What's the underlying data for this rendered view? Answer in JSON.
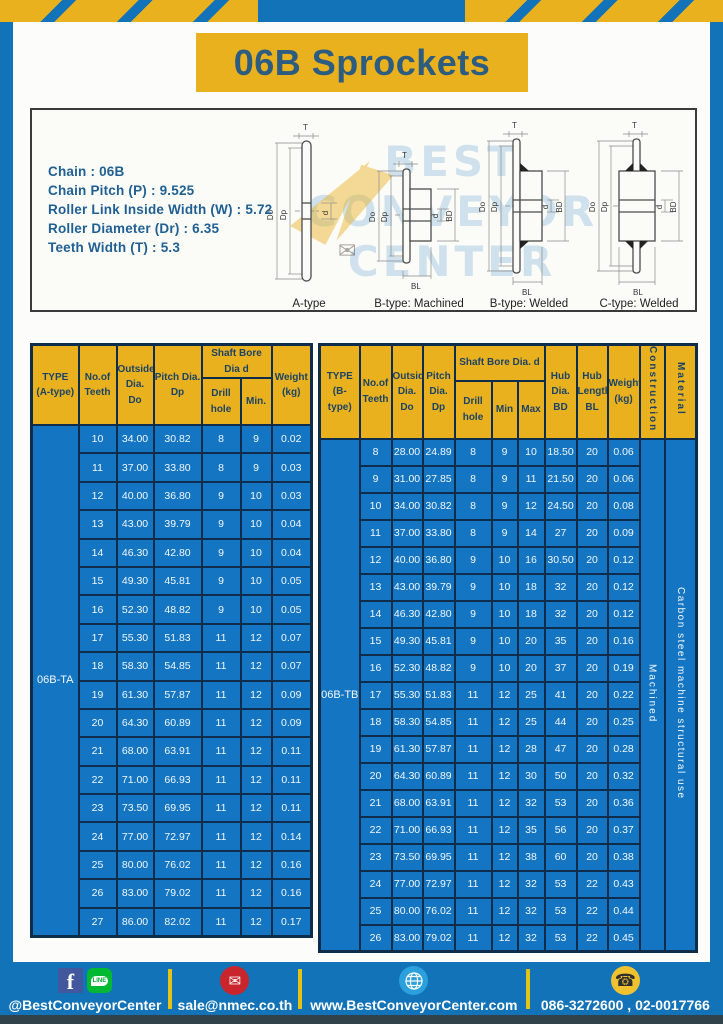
{
  "title": "06B Sprockets",
  "specs": [
    "Chain  : 06B",
    "Chain Pitch (P)  :  9.525",
    "Roller Link Inside Width (W)  :  5.72",
    "Roller Diameter (Dr)  : 6.35",
    "Teeth Width (T)  :  5.3"
  ],
  "diagram": {
    "types": [
      "A-type",
      "B-type: Machined",
      "B-type: Welded",
      "C-type: Welded"
    ],
    "dims": {
      "t": "T",
      "outside": "Do",
      "pitch": "Dp",
      "bore": "d",
      "hub_dia": "BD",
      "hub_len": "BL"
    },
    "watermark": [
      "BEST",
      "CONVEYOR",
      "CENTER"
    ],
    "watermark_envelope_icon": "✉"
  },
  "table_a": {
    "headers": {
      "type": [
        "TYPE",
        "(A-type)"
      ],
      "teeth": [
        "No.of",
        "Teeth"
      ],
      "outside": [
        "Outside",
        "Dia.",
        "Do"
      ],
      "pitch": [
        "Pitch Dia.",
        "Dp"
      ],
      "shaft_group": "Shaft Bore Dia d",
      "drill": "Drill hole",
      "min": "Min.",
      "weight": [
        "Weight",
        "(kg)"
      ]
    },
    "type_value": "06B-TA",
    "rows": [
      [
        "10",
        "34.00",
        "30.82",
        "8",
        "9",
        "0.02"
      ],
      [
        "11",
        "37.00",
        "33.80",
        "8",
        "9",
        "0.03"
      ],
      [
        "12",
        "40.00",
        "36.80",
        "9",
        "10",
        "0.03"
      ],
      [
        "13",
        "43.00",
        "39.79",
        "9",
        "10",
        "0.04"
      ],
      [
        "14",
        "46.30",
        "42.80",
        "9",
        "10",
        "0.04"
      ],
      [
        "15",
        "49.30",
        "45.81",
        "9",
        "10",
        "0.05"
      ],
      [
        "16",
        "52.30",
        "48.82",
        "9",
        "10",
        "0.05"
      ],
      [
        "17",
        "55.30",
        "51.83",
        "11",
        "12",
        "0.07"
      ],
      [
        "18",
        "58.30",
        "54.85",
        "11",
        "12",
        "0.07"
      ],
      [
        "19",
        "61.30",
        "57.87",
        "11",
        "12",
        "0.09"
      ],
      [
        "20",
        "64.30",
        "60.89",
        "11",
        "12",
        "0.09"
      ],
      [
        "21",
        "68.00",
        "63.91",
        "11",
        "12",
        "0.11"
      ],
      [
        "22",
        "71.00",
        "66.93",
        "11",
        "12",
        "0.11"
      ],
      [
        "23",
        "73.50",
        "69.95",
        "11",
        "12",
        "0.11"
      ],
      [
        "24",
        "77.00",
        "72.97",
        "11",
        "12",
        "0.14"
      ],
      [
        "25",
        "80.00",
        "76.02",
        "11",
        "12",
        "0.16"
      ],
      [
        "26",
        "83.00",
        "79.02",
        "11",
        "12",
        "0.16"
      ],
      [
        "27",
        "86.00",
        "82.02",
        "11",
        "12",
        "0.17"
      ]
    ]
  },
  "table_b": {
    "headers": {
      "type": [
        "TYPE",
        "(B-type)"
      ],
      "teeth": [
        "No.of",
        "Teeth"
      ],
      "outside": [
        "Outside",
        "Dia.",
        "Do"
      ],
      "pitch": [
        "Pitch",
        "Dia.",
        "Dp"
      ],
      "shaft_group": "Shaft Bore Dia.  d",
      "drill": "Drill hole",
      "min": "Min",
      "max": "Max",
      "hub_dia": [
        "Hub",
        "Dia.",
        "BD"
      ],
      "hub_len": [
        "Hub",
        "Length",
        "BL"
      ],
      "weight": [
        "Weight",
        "(kg)"
      ],
      "construction": "Construction",
      "material": "Material"
    },
    "type_value": "06B-TB",
    "construction_value": "Machined",
    "material_value": "Carbon steel machine structural use",
    "rows": [
      [
        "8",
        "28.00",
        "24.89",
        "8",
        "9",
        "10",
        "18.50",
        "20",
        "0.06"
      ],
      [
        "9",
        "31.00",
        "27.85",
        "8",
        "9",
        "11",
        "21.50",
        "20",
        "0.06"
      ],
      [
        "10",
        "34.00",
        "30.82",
        "8",
        "9",
        "12",
        "24.50",
        "20",
        "0.08"
      ],
      [
        "11",
        "37.00",
        "33.80",
        "8",
        "9",
        "14",
        "27",
        "20",
        "0.09"
      ],
      [
        "12",
        "40.00",
        "36.80",
        "9",
        "10",
        "16",
        "30.50",
        "20",
        "0.12"
      ],
      [
        "13",
        "43.00",
        "39.79",
        "9",
        "10",
        "18",
        "32",
        "20",
        "0.12"
      ],
      [
        "14",
        "46.30",
        "42.80",
        "9",
        "10",
        "18",
        "32",
        "20",
        "0.12"
      ],
      [
        "15",
        "49.30",
        "45.81",
        "9",
        "10",
        "20",
        "35",
        "20",
        "0.16"
      ],
      [
        "16",
        "52.30",
        "48.82",
        "9",
        "10",
        "20",
        "37",
        "20",
        "0.19"
      ],
      [
        "17",
        "55.30",
        "51.83",
        "11",
        "12",
        "25",
        "41",
        "20",
        "0.22"
      ],
      [
        "18",
        "58.30",
        "54.85",
        "11",
        "12",
        "25",
        "44",
        "20",
        "0.25"
      ],
      [
        "19",
        "61.30",
        "57.87",
        "11",
        "12",
        "28",
        "47",
        "20",
        "0.28"
      ],
      [
        "20",
        "64.30",
        "60.89",
        "11",
        "12",
        "30",
        "50",
        "20",
        "0.32"
      ],
      [
        "21",
        "68.00",
        "63.91",
        "11",
        "12",
        "32",
        "53",
        "20",
        "0.36"
      ],
      [
        "22",
        "71.00",
        "66.93",
        "11",
        "12",
        "35",
        "56",
        "20",
        "0.37"
      ],
      [
        "23",
        "73.50",
        "69.95",
        "11",
        "12",
        "38",
        "60",
        "20",
        "0.38"
      ],
      [
        "24",
        "77.00",
        "72.97",
        "11",
        "12",
        "32",
        "53",
        "22",
        "0.43"
      ],
      [
        "25",
        "80.00",
        "76.02",
        "11",
        "12",
        "32",
        "53",
        "22",
        "0.44"
      ],
      [
        "26",
        "83.00",
        "79.02",
        "11",
        "12",
        "32",
        "53",
        "22",
        "0.45"
      ]
    ]
  },
  "footer": {
    "social_text": "@BestConveyorCenter",
    "email": "sale@nmec.co.th",
    "website": "www.BestConveyorCenter.com",
    "phone": "086-3272600 , 02-0017766",
    "facebook_glyph": "f",
    "line_glyph": "LINE",
    "email_glyph": "✉",
    "phone_glyph": "☎"
  },
  "colors": {
    "frame_blue": "#1273b8",
    "accent_yellow": "#eab11f",
    "cell_blue": "#1476c2",
    "border_navy": "#0e2d4b",
    "title_navy": "#2c5c80"
  }
}
